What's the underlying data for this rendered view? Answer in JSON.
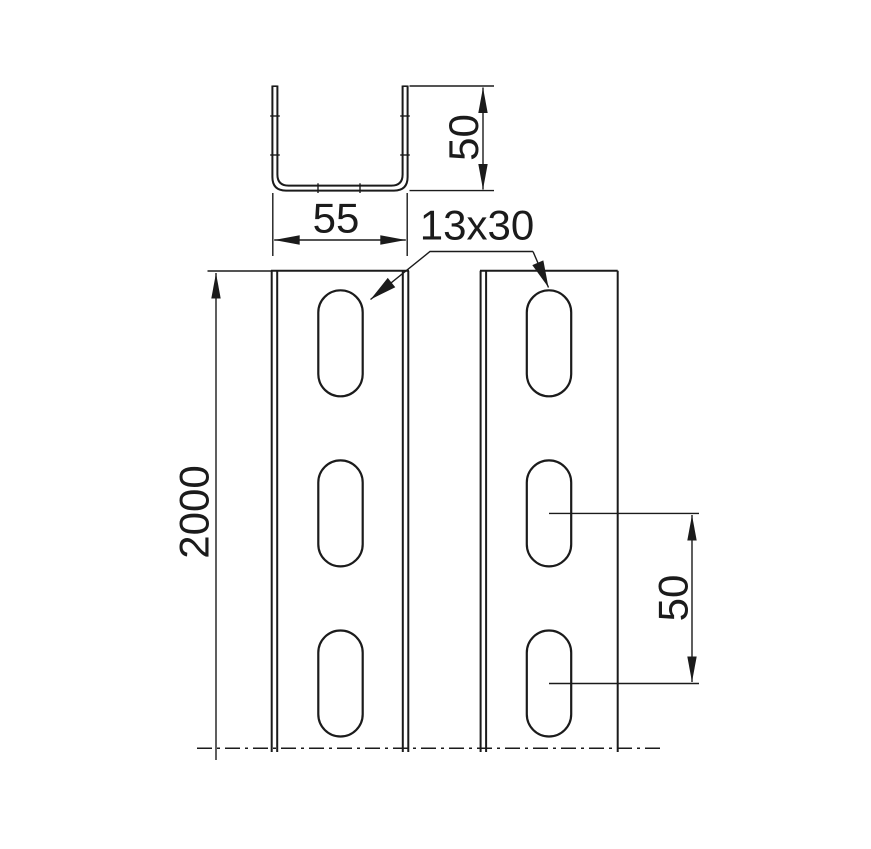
{
  "drawing": {
    "colors": {
      "background": "#ffffff",
      "line": "#1b1b1b"
    },
    "labels": {
      "section_width": "55",
      "section_height": "50",
      "slot_size": "13x30",
      "profile_length": "2000",
      "slot_spacing": "50"
    }
  }
}
